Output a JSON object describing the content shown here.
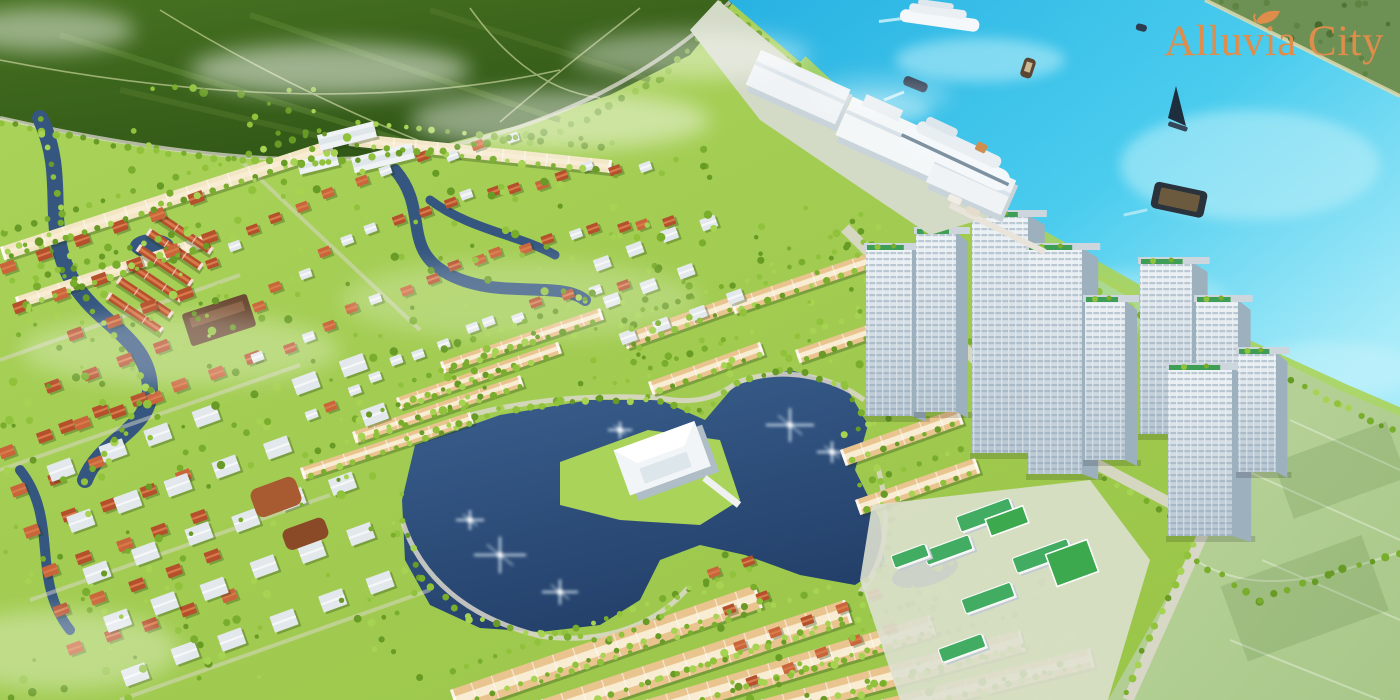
{
  "meta": {
    "title": "Alluvia City riverside township aerial masterplan rendering"
  },
  "logo": {
    "text": "Alluvia City",
    "icon": "leaf-icon",
    "color": "#df8d4b"
  },
  "colors": {
    "water_deep": "#28b2e2",
    "water_mid": "#4accee",
    "water_light": "#a9ecf9",
    "far_bank": "#6d9054",
    "sand_edge": "#e3dcb0",
    "farm_dark": "#2f5516",
    "farm_mid": "#477221",
    "farm_path": "#cdd9a0",
    "land": "#98c447",
    "land_light": "#aad35a",
    "lake_top": "#3c6190",
    "lake_deep": "#23406a",
    "canal": "#35577f",
    "roof_red": "#b5502c",
    "roof_red2": "#c9653a",
    "red_light": "#d97a4b",
    "roof_white": "#e3e8ec",
    "white_light": "#f5f7f9",
    "roof_tan": "#eac48f",
    "tan_ridge": "#f8ecd2",
    "row_cream": "#f2e6c4",
    "tower_face": "#eef3f6",
    "tower_face2": "#b7c6d2",
    "tower_side": "#9db0be",
    "tower_green": "#3f9e55",
    "parapet": "#cdd6dd",
    "school_roof": "#43ac63",
    "school_ground": "#dde0cf",
    "court_green": "#3da94f",
    "field": "#a8c789",
    "field_light": "#bdd69c",
    "road": "#dcd8cd",
    "tree1": "#79ad2c",
    "tree2": "#90c23c",
    "tree3": "#a6d351",
    "tree4": "#689b25",
    "terminal_white": "#eff3f5",
    "concrete": "#d3dac6",
    "ship_white": "#f5f8fa",
    "hull_dark": "#24354a",
    "barge_hull": "#2a323c",
    "barge_cargo": "#6b5a3e",
    "window_line": "#8ba0b2",
    "mist": "#ffffff"
  },
  "scene": {
    "regions": [
      {
        "id": "river",
        "label": "river"
      },
      {
        "id": "far-riverbank",
        "label": "far riverbank"
      },
      {
        "id": "farmland",
        "label": "farmland"
      },
      {
        "id": "cruise-terminal",
        "label": "cruise terminal"
      },
      {
        "id": "docked-cruise-ship",
        "label": "docked cruise ship"
      },
      {
        "id": "sailing-cruise-ship",
        "label": "sailing cruise ship"
      },
      {
        "id": "sailboat",
        "label": "sailboat"
      },
      {
        "id": "cargo-barge",
        "label": "cargo barge"
      },
      {
        "id": "speedboat",
        "label": "speedboat"
      },
      {
        "id": "highrise-cluster",
        "label": "high-rise towers"
      },
      {
        "id": "central-lake",
        "label": "central lake"
      },
      {
        "id": "clubhouse",
        "label": "lakeside clubhouse"
      },
      {
        "id": "villa-districts",
        "label": "villa districts"
      },
      {
        "id": "shophouse-rows",
        "label": "shophouse rows"
      },
      {
        "id": "school-campus",
        "label": "school campus"
      },
      {
        "id": "sports-fields",
        "label": "fields"
      },
      {
        "id": "canal-network",
        "label": "canals"
      }
    ]
  }
}
